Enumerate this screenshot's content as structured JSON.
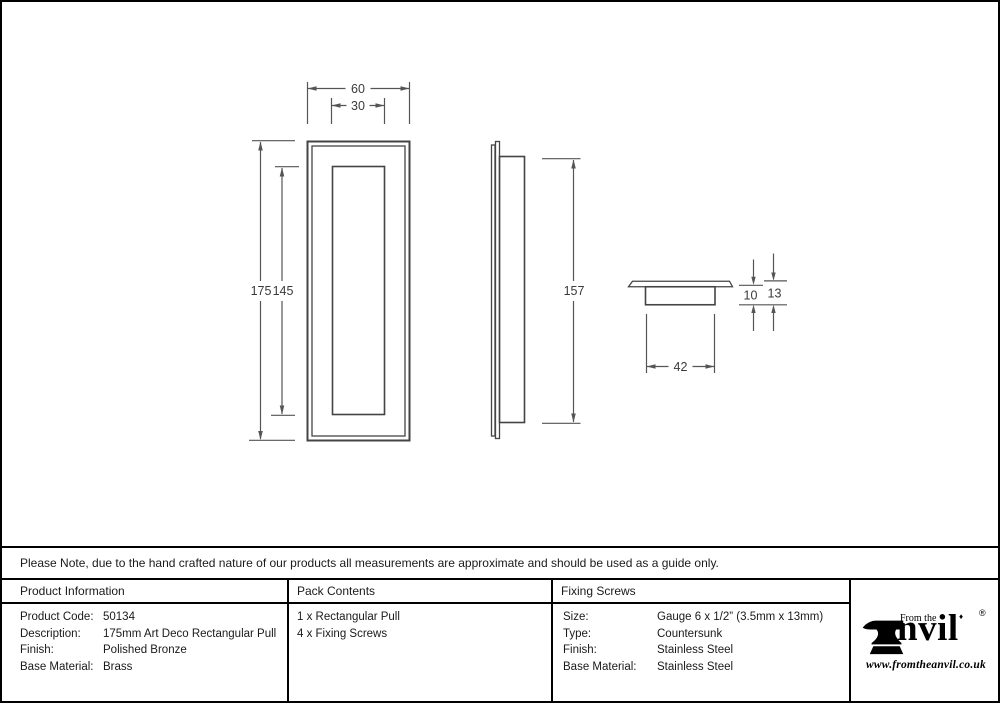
{
  "note": "Please Note, due to the hand crafted nature of our products all measurements are approximate and should be used as a guide only.",
  "dimensions": {
    "front_width": "60",
    "front_inner_width": "30",
    "front_height": "175",
    "front_inner_height": "145",
    "side_height": "157",
    "cup_depth": "10",
    "total_depth": "13",
    "cup_width": "42"
  },
  "table": {
    "product_information": {
      "header": "Product Information",
      "rows": [
        {
          "label": "Product Code:",
          "value": "50134"
        },
        {
          "label": "Description:",
          "value": "175mm Art Deco Rectangular Pull"
        },
        {
          "label": "Finish:",
          "value": "Polished Bronze"
        },
        {
          "label": "Base Material:",
          "value": "Brass"
        }
      ]
    },
    "pack_contents": {
      "header": "Pack Contents",
      "items": [
        "1 x Rectangular Pull",
        "4 x Fixing Screws"
      ]
    },
    "fixing_screws": {
      "header": "Fixing Screws",
      "rows": [
        {
          "label": "Size:",
          "value": "Gauge 6 x 1/2” (3.5mm x 13mm)"
        },
        {
          "label": "Type:",
          "value": "Countersunk"
        },
        {
          "label": "Finish:",
          "value": "Stainless Steel"
        },
        {
          "label": "Base Material:",
          "value": "Stainless Steel"
        }
      ]
    }
  },
  "logo": {
    "tagline": "From the",
    "wordmark": "nvil",
    "registered_mark": "®",
    "diamond": "♦",
    "website": "www.fromtheanvil.co.uk"
  },
  "colors": {
    "drawing_line": "#4a4a4a",
    "border": "#000000",
    "text": "#1a1a1a"
  }
}
